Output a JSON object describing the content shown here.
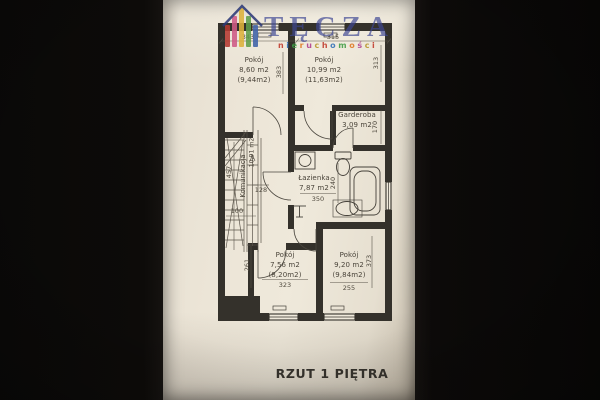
{
  "floorplan": {
    "caption": "RZUT 1 PIĘTRA",
    "rooms": [
      {
        "name": "Pokój",
        "area": "8,60 m2",
        "area_alt": "(9,44m2)"
      },
      {
        "name": "Pokój",
        "area": "10,99 m2",
        "area_alt": "(11,63m2)"
      },
      {
        "name": "Garderoba",
        "area": "3,09 m2"
      },
      {
        "name": "Łazienka",
        "area": "7,87 m2"
      },
      {
        "name": "Pokój",
        "area": "7,56 m2",
        "area_alt": "(8,20m2)"
      },
      {
        "name": "Pokój",
        "area": "9,20 m2",
        "area_alt": "(9,84m2)"
      },
      {
        "name": "Komunikacja",
        "area": "10,91 m2"
      }
    ],
    "dimensions": {
      "top_left": "343",
      "top_right": "315",
      "room_tl_depth": "383",
      "room_tr_depth": "313",
      "garderoba_depth": "170",
      "bath_width": "350",
      "bath_depth": "240",
      "hall_door": "128",
      "hall_length": "457",
      "stair_width": "100",
      "room_bl_side": "261",
      "room_bl_width": "323",
      "room_br_width": "255",
      "room_br_depth": "373"
    }
  },
  "logo": {
    "brand": "TĘCZA",
    "tagline": "nieruchomości",
    "brand_color": "rgba(62,70,148,0.78)",
    "roof_color": "#2d3a78",
    "house_colors": [
      "#b43a31",
      "#cf5a86",
      "#ddb23c",
      "#5f9e4a",
      "#3f63a8"
    ],
    "letter_colors": [
      "#c0392b",
      "#2f6fb8",
      "#3f9c45",
      "#e07820",
      "#b03a8c",
      "#b8952a"
    ]
  }
}
